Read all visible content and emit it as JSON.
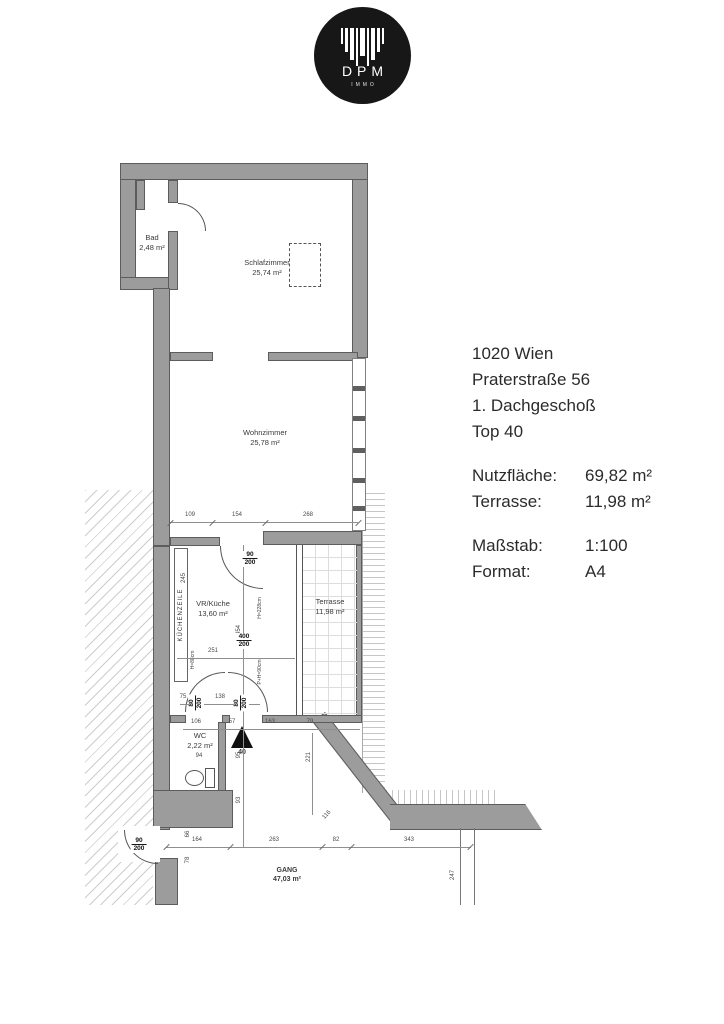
{
  "logo": {
    "brand": "DPM",
    "sub": "IMMO"
  },
  "info": {
    "address_lines": [
      "1020 Wien",
      "Praterstraße 56",
      "1. Dachgeschoß",
      "Top 40"
    ],
    "areas": [
      {
        "label": "Nutzfläche:",
        "value": "69,82 m²"
      },
      {
        "label": "Terrasse:",
        "value": "11,98 m²"
      }
    ],
    "meta": [
      {
        "label": "Maßstab:",
        "value": "1:100"
      },
      {
        "label": "Format:",
        "value": "A4"
      }
    ]
  },
  "rooms": [
    {
      "name": "Bad",
      "area": "2,48 m²"
    },
    {
      "name": "Schlafzimmer",
      "area": "25,74 m²"
    },
    {
      "name": "Wohnzimmer",
      "area": "25,78 m²"
    },
    {
      "name": "VR/Küche",
      "area": "13,60 m²"
    },
    {
      "name": "Terrasse",
      "area": "11,98 m²"
    },
    {
      "name": "WC",
      "area": "2,22 m²"
    },
    {
      "name": "GANG",
      "area": "47,03 m²"
    }
  ],
  "entrance_number": "40",
  "annotations": {
    "kitchen_unit": "KÜCHENZEILE",
    "kitchen_unit_height": "H=88cm",
    "glass_upper": "H=228cm",
    "glass_lower": "P+H=90cm"
  },
  "dimensions": [
    {
      "t": "109",
      "x": 190,
      "y": 515,
      "r": 0
    },
    {
      "t": "154",
      "x": 237,
      "y": 515,
      "r": 0
    },
    {
      "t": "268",
      "x": 308,
      "y": 515,
      "r": 0
    },
    {
      "t": "251",
      "x": 213,
      "y": 651,
      "r": 0
    },
    {
      "t": "75",
      "x": 183,
      "y": 697,
      "r": 0
    },
    {
      "t": "138",
      "x": 220,
      "y": 697,
      "r": 0
    },
    {
      "t": "106",
      "x": 196,
      "y": 722,
      "r": 0
    },
    {
      "t": "57",
      "x": 232,
      "y": 722,
      "r": 0
    },
    {
      "t": "163",
      "x": 270,
      "y": 722,
      "r": 0
    },
    {
      "t": "79",
      "x": 310,
      "y": 722,
      "r": 0
    },
    {
      "t": "164",
      "x": 197,
      "y": 840,
      "r": 0
    },
    {
      "t": "263",
      "x": 274,
      "y": 840,
      "r": 0
    },
    {
      "t": "82",
      "x": 336,
      "y": 840,
      "r": 0
    },
    {
      "t": "343",
      "x": 409,
      "y": 840,
      "r": 0
    },
    {
      "t": "94",
      "x": 199,
      "y": 756,
      "r": 0
    },
    {
      "t": "245",
      "x": 184,
      "y": 578,
      "r": -90
    },
    {
      "t": "454",
      "x": 239,
      "y": 630,
      "r": -90
    },
    {
      "t": "95",
      "x": 239,
      "y": 755,
      "r": -90
    },
    {
      "t": "93",
      "x": 239,
      "y": 800,
      "r": -90
    },
    {
      "t": "221",
      "x": 309,
      "y": 757,
      "r": -90
    },
    {
      "t": "247",
      "x": 453,
      "y": 875,
      "r": -90
    },
    {
      "t": "66",
      "x": 188,
      "y": 834,
      "r": -90
    },
    {
      "t": "78",
      "x": 188,
      "y": 860,
      "r": -90
    },
    {
      "t": "116",
      "x": 327,
      "y": 815,
      "r": -48
    }
  ],
  "door_sizes": [
    {
      "num": "90",
      "den": "200",
      "x": 250,
      "y": 559,
      "r": 0
    },
    {
      "num": "400",
      "den": "200",
      "x": 244,
      "y": 641,
      "r": 0
    },
    {
      "num": "80",
      "den": "200",
      "x": 196,
      "y": 703,
      "r": -90
    },
    {
      "num": "80",
      "den": "200",
      "x": 241,
      "y": 703,
      "r": -90
    },
    {
      "num": "90",
      "den": "200",
      "x": 139,
      "y": 845,
      "r": 0
    }
  ]
}
